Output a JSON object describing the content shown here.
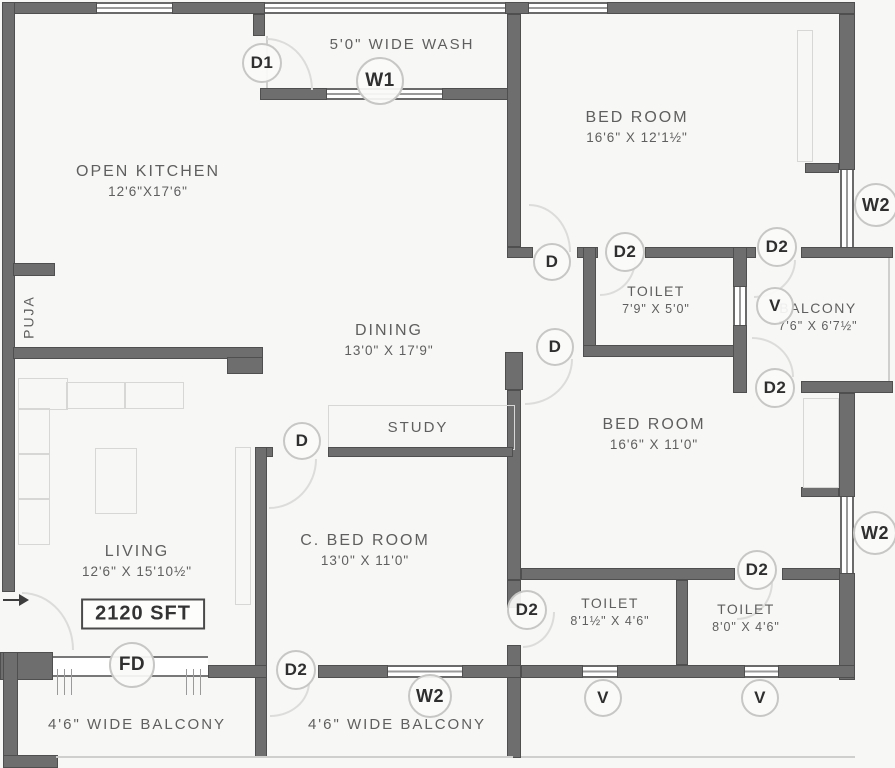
{
  "plan": {
    "total_area": "2120 SFT",
    "rooms": {
      "open_kitchen": {
        "name": "OPEN KITCHEN",
        "dims": "12'6\"X17'6\""
      },
      "wash": {
        "name": "5'0\"  WIDE  WASH"
      },
      "puja": {
        "name": "PUJA"
      },
      "bed_room_1": {
        "name": "BED ROOM",
        "dims": "16'6\" X 12'1½\""
      },
      "toilet_1": {
        "name": "TOILET",
        "dims": "7'9\" X 5'0\""
      },
      "balcony_right": {
        "name": "BALCONY",
        "dims": "7'6\" X 6'7½\""
      },
      "dining": {
        "name": "DINING",
        "dims": "13'0\" X 17'9\""
      },
      "study": {
        "name": "STUDY"
      },
      "bed_room_2": {
        "name": "BED ROOM",
        "dims": "16'6\" X 11'0\""
      },
      "c_bed_room": {
        "name": "C. BED ROOM",
        "dims": "13'0\" X 11'0\""
      },
      "living": {
        "name": "LIVING",
        "dims": "12'6\" X 15'10½\""
      },
      "toilet_2": {
        "name": "TOILET",
        "dims": "8'1½\" X 4'6\""
      },
      "toilet_3": {
        "name": "TOILET",
        "dims": "8'0\" X 4'6\""
      },
      "balcony_left": {
        "name": "4'6\"  WIDE  BALCONY"
      },
      "balcony_center": {
        "name": "4'6\"  WIDE  BALCONY"
      }
    },
    "markers": {
      "d": "D",
      "d1": "D1",
      "d2": "D2",
      "w1": "W1",
      "w2": "W2",
      "v": "V",
      "fd": "FD"
    },
    "colors": {
      "wall": "#6e6e6e",
      "wall_edge": "#4f4f4f",
      "text": "#5f5f5f",
      "marker_text": "#2f2f2f",
      "background": "#f7f7f5"
    }
  }
}
